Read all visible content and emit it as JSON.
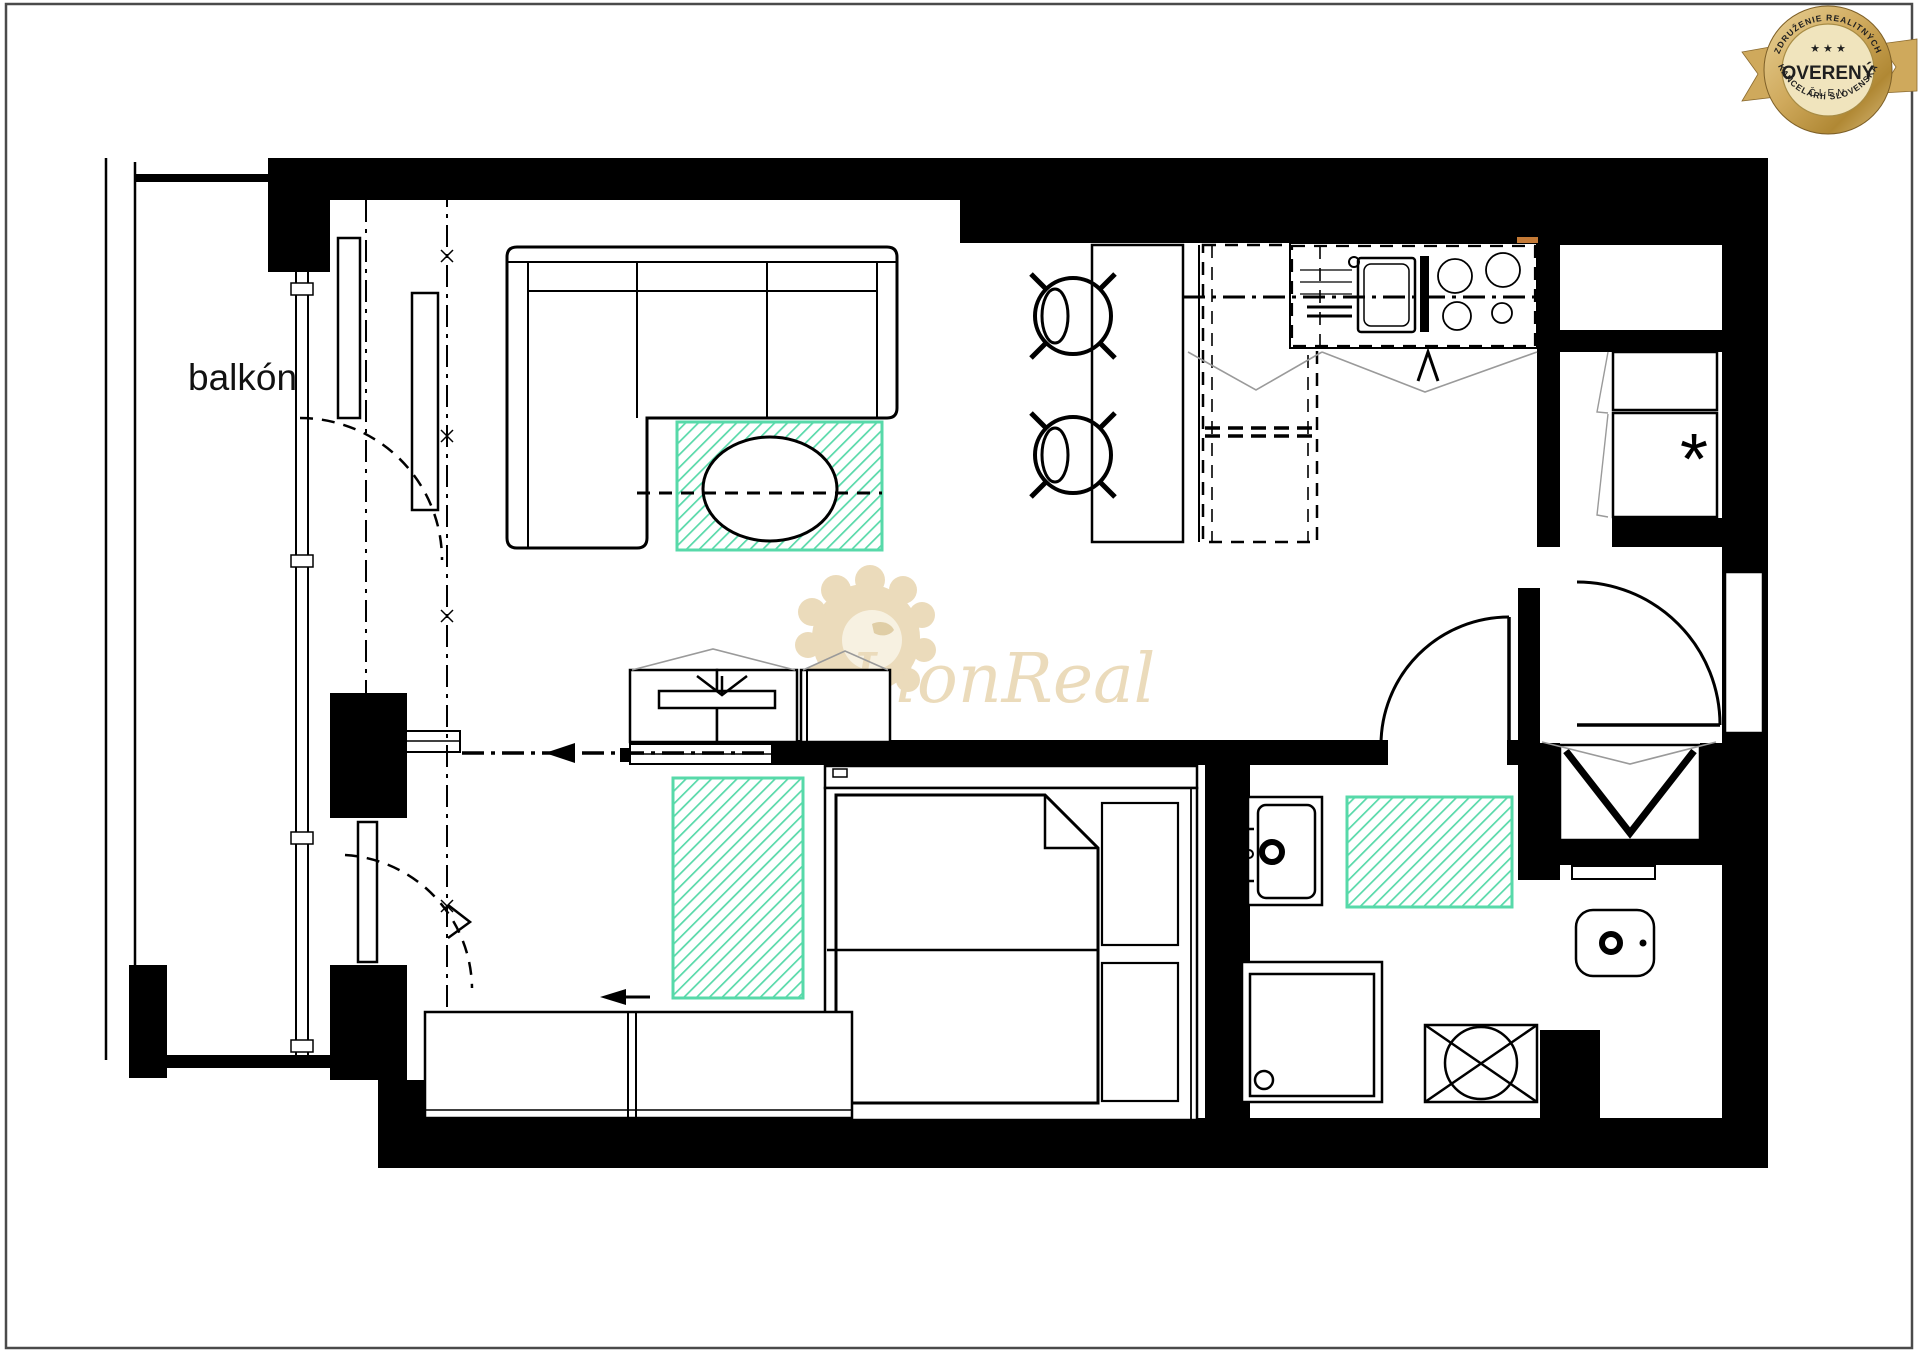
{
  "page": {
    "background": "#ffffff",
    "border_color": "#4a4a4a"
  },
  "badge": {
    "arc_top": "ZDRUŽENIE REALITNÝCH",
    "main": "OVERENÝ",
    "sub": "ČLEN",
    "arc_bottom": "KANCELÁRIÍ SLOVENSKA",
    "stars": "★ ★ ★",
    "gold_light": "#ecd9a4",
    "gold_mid": "#cfa95c",
    "gold_dark": "#a5812f",
    "text_color": "#1f1f1f"
  },
  "watermark": {
    "text": "LionReal",
    "color": "#e7d3ab"
  },
  "plan": {
    "balcony_label": "balkón",
    "freezer_symbol": "*",
    "colors": {
      "wall": "#000000",
      "rug": "#57d9a9",
      "swing": "#9a9a9a",
      "accent": "#c47a36"
    }
  }
}
